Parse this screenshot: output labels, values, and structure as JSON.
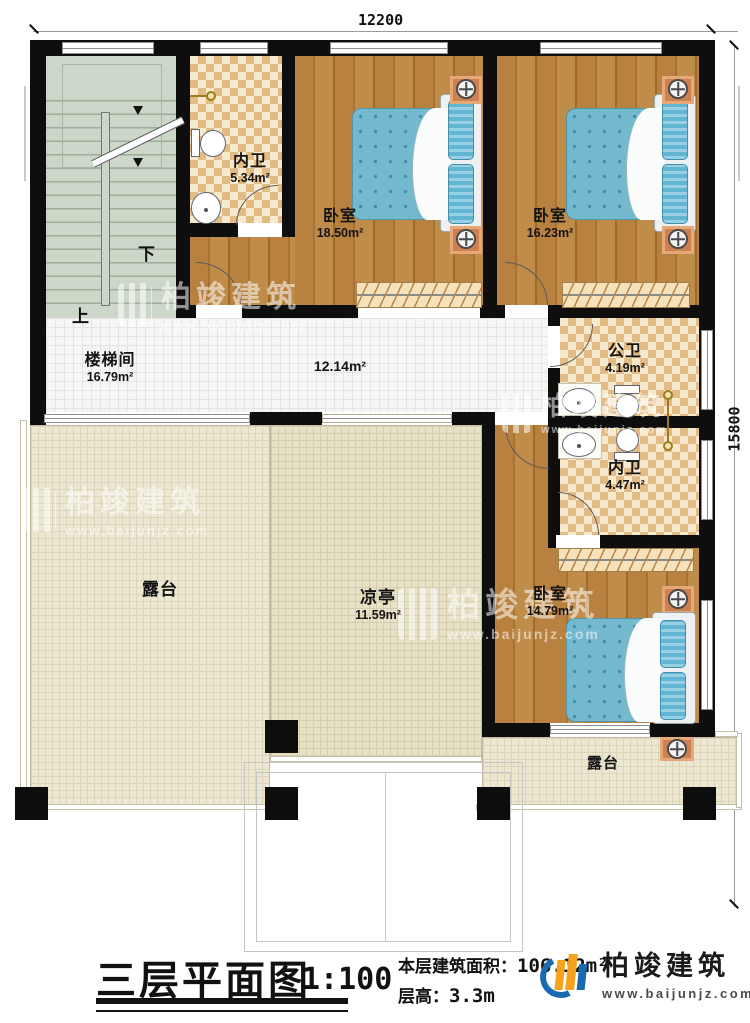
{
  "dimensions": {
    "top": "12200",
    "right": "15800"
  },
  "rooms": {
    "stairwell": {
      "name": "楼梯间",
      "area": "16.79m²"
    },
    "stair_down": "下",
    "stair_up": "上",
    "bath_top": {
      "name": "内卫",
      "area": "5.34m²"
    },
    "bedroom1": {
      "name": "卧室",
      "area": "18.50m²"
    },
    "bedroom2": {
      "name": "卧室",
      "area": "16.23m²"
    },
    "corridor": {
      "area": "12.14m²"
    },
    "public_bath": {
      "name": "公卫",
      "area": "4.19m²"
    },
    "bath_mid": {
      "name": "内卫",
      "area": "4.47m²"
    },
    "bedroom3": {
      "name": "卧室",
      "area": "14.79m²"
    },
    "terrace_left": {
      "name": "露台"
    },
    "pavilion": {
      "name": "凉亭",
      "area": "11.59m²"
    },
    "terrace_right": {
      "name": "露台"
    }
  },
  "title_block": {
    "title": "三层平面图",
    "scale": "1:100",
    "area_label": "本层建筑面积：",
    "area_value": "106.12m²",
    "height_label": "层高：",
    "height_value": "3.3m"
  },
  "brand": {
    "name": "柏竣建筑",
    "url": "www.baijunjz.com"
  },
  "watermark": {
    "name": "柏竣建筑",
    "url": "www.baijunjz.com"
  },
  "colors": {
    "wall": "#0e0e0e",
    "wood": "#b0793a",
    "bed": "#74b9ce",
    "brand_blue": "#1a6ab1",
    "brand_orange": "#f6a21c"
  }
}
